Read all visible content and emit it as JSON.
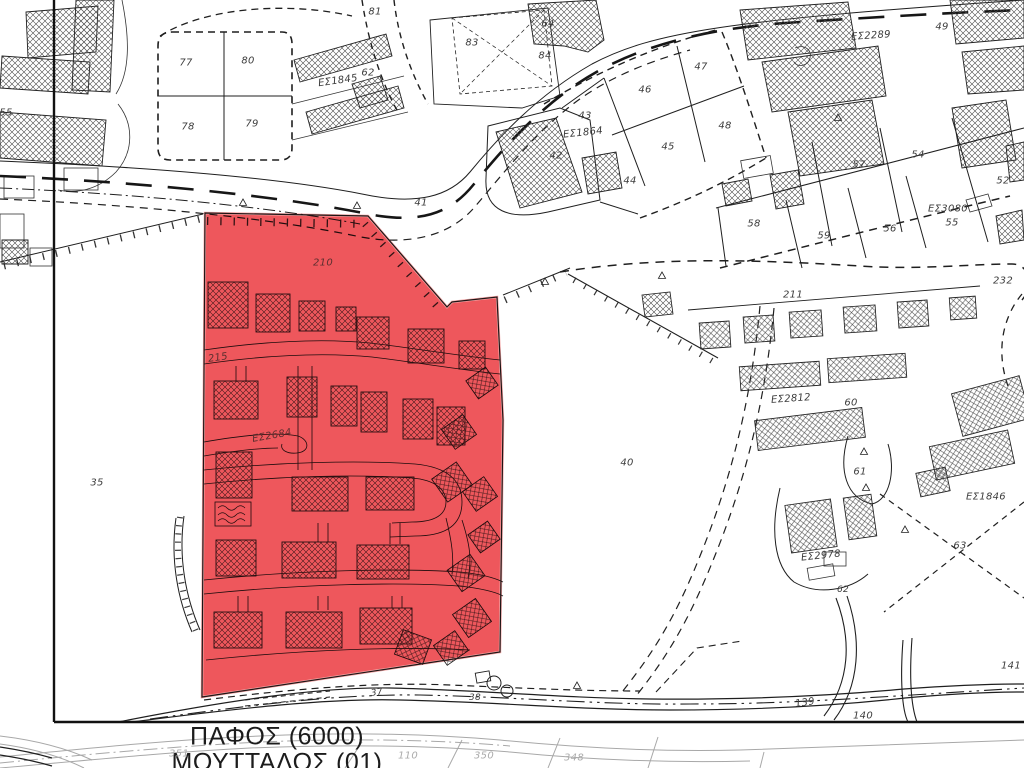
{
  "map": {
    "type": "cadastral-plan",
    "municipality": "ΠΑΦΟΣ (6000)",
    "quarter": "ΜΟΥΤΤΑΛΟΣ (01)",
    "highlight_color": "#ee575c",
    "background_color": "#ffffff",
    "line_color": "#1f1f1f",
    "faded_line_color": "#a8a8a8",
    "highlighted_parcel_labels": [
      "210",
      "215",
      "ΕΣ2684"
    ]
  },
  "labels": [
    {
      "t": "55",
      "x": 6,
      "y": 113
    },
    {
      "t": "77",
      "x": 186,
      "y": 63
    },
    {
      "t": "80",
      "x": 248,
      "y": 61
    },
    {
      "t": "78",
      "x": 188,
      "y": 127
    },
    {
      "t": "79",
      "x": 252,
      "y": 124
    },
    {
      "t": "ΕΣ1845",
      "x": 338,
      "y": 81,
      "r": -8
    },
    {
      "t": "62",
      "x": 368,
      "y": 73
    },
    {
      "t": "81",
      "x": 375,
      "y": 12
    },
    {
      "t": "64",
      "x": 548,
      "y": 24
    },
    {
      "t": "83",
      "x": 472,
      "y": 43
    },
    {
      "t": "84",
      "x": 545,
      "y": 56
    },
    {
      "t": "41",
      "x": 421,
      "y": 203
    },
    {
      "t": "43",
      "x": 585,
      "y": 116
    },
    {
      "t": "ΕΣ1864",
      "x": 583,
      "y": 133,
      "r": -6
    },
    {
      "t": "42",
      "x": 556,
      "y": 156
    },
    {
      "t": "44",
      "x": 630,
      "y": 181
    },
    {
      "t": "45",
      "x": 668,
      "y": 147
    },
    {
      "t": "46",
      "x": 645,
      "y": 90
    },
    {
      "t": "47",
      "x": 701,
      "y": 67
    },
    {
      "t": "48",
      "x": 725,
      "y": 126
    },
    {
      "t": "ΕΣ2289",
      "x": 871,
      "y": 36,
      "r": -4
    },
    {
      "t": "49",
      "x": 942,
      "y": 27
    },
    {
      "t": "57",
      "x": 859,
      "y": 165
    },
    {
      "t": "54",
      "x": 918,
      "y": 155
    },
    {
      "t": "52",
      "x": 1003,
      "y": 181
    },
    {
      "t": "ΕΣ3080",
      "x": 948,
      "y": 209
    },
    {
      "t": "55",
      "x": 952,
      "y": 223
    },
    {
      "t": "58",
      "x": 754,
      "y": 224
    },
    {
      "t": "59",
      "x": 824,
      "y": 236
    },
    {
      "t": "56",
      "x": 890,
      "y": 229
    },
    {
      "t": "232",
      "x": 1003,
      "y": 281
    },
    {
      "t": "211",
      "x": 793,
      "y": 295
    },
    {
      "t": "210",
      "x": 323,
      "y": 263,
      "c": "#5c2f2f"
    },
    {
      "t": "215",
      "x": 218,
      "y": 358,
      "r": -8,
      "c": "#5c2f2f"
    },
    {
      "t": "ΕΣ2684",
      "x": 272,
      "y": 436,
      "r": -10,
      "c": "#5c2f2f"
    },
    {
      "t": "35",
      "x": 97,
      "y": 483
    },
    {
      "t": "40",
      "x": 627,
      "y": 463
    },
    {
      "t": "ΕΣ2812",
      "x": 791,
      "y": 399,
      "r": -4
    },
    {
      "t": "60",
      "x": 851,
      "y": 403
    },
    {
      "t": "61",
      "x": 860,
      "y": 472
    },
    {
      "t": "ΕΣ1846",
      "x": 986,
      "y": 497
    },
    {
      "t": "63",
      "x": 960,
      "y": 546
    },
    {
      "t": "ΕΣ2978",
      "x": 821,
      "y": 556,
      "r": -6
    },
    {
      "t": "62",
      "x": 843,
      "y": 590,
      "s": 9
    },
    {
      "t": "37",
      "x": 377,
      "y": 693,
      "s": 9,
      "r": -8
    },
    {
      "t": "38",
      "x": 475,
      "y": 698,
      "s": 9
    },
    {
      "t": "139",
      "x": 805,
      "y": 703,
      "r": -8
    },
    {
      "t": "140",
      "x": 863,
      "y": 716
    },
    {
      "t": "141",
      "x": 1011,
      "y": 666
    },
    {
      "t": "ΠΑΦΟΣ (6000)",
      "x": 277,
      "y": 737,
      "n": "area-title-pafos"
    },
    {
      "t": "ΜΟΥΤΤΑΛΟΣ (01)",
      "x": 277,
      "y": 763,
      "n": "area-title-mouttalos"
    },
    {
      "t": "351",
      "x": 179,
      "y": 754,
      "c": "#ababab"
    },
    {
      "t": "110",
      "x": 408,
      "y": 756,
      "c": "#ababab"
    },
    {
      "t": "350",
      "x": 484,
      "y": 756,
      "c": "#ababab"
    },
    {
      "t": "348",
      "x": 574,
      "y": 758,
      "c": "#ababab"
    }
  ]
}
